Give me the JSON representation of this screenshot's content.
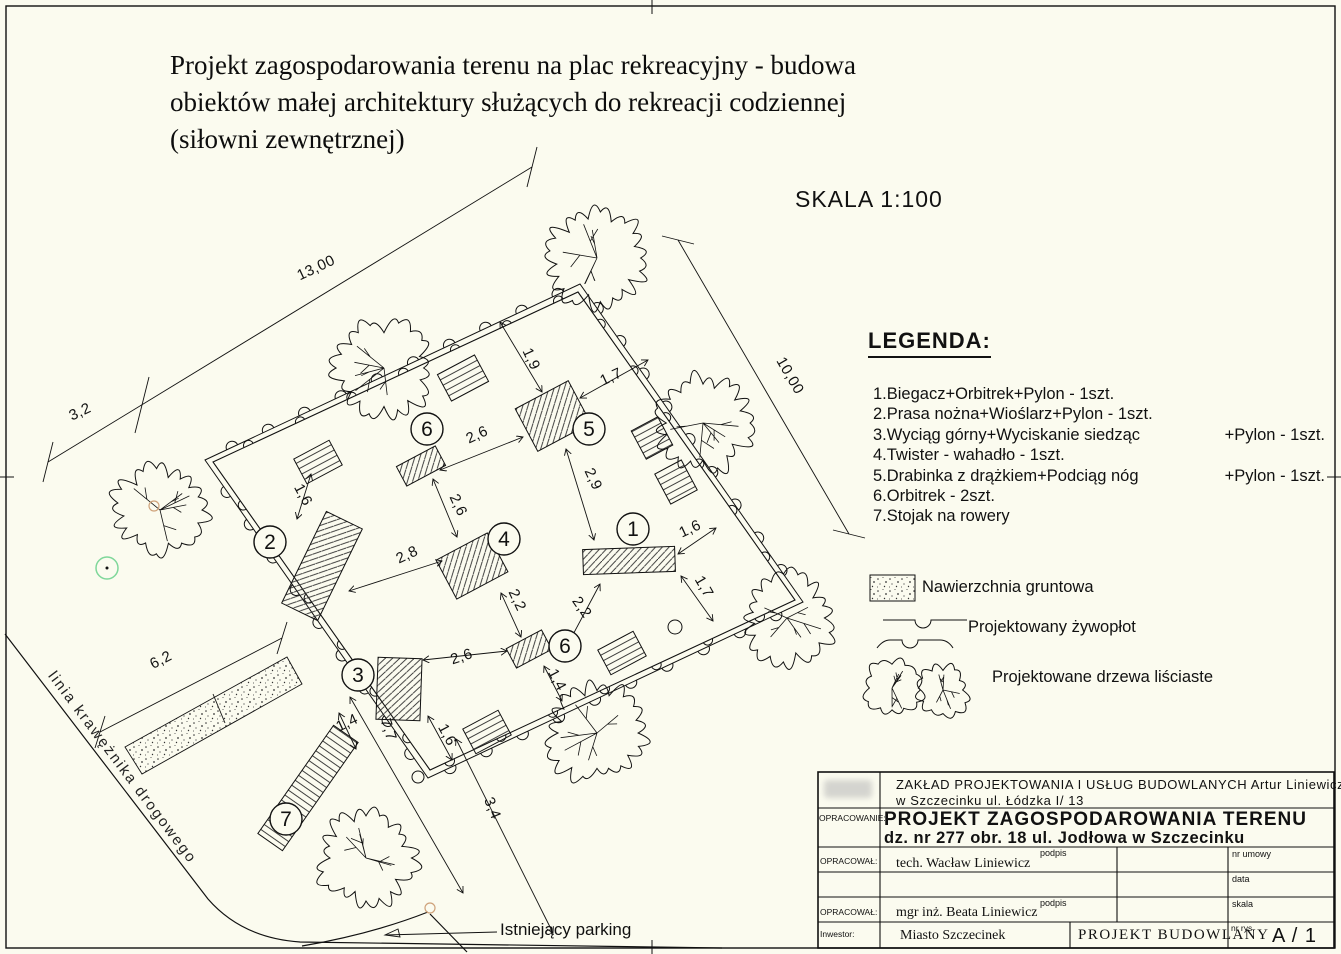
{
  "page": {
    "title_lines": [
      "Projekt zagospodarowania terenu na plac rekreacyjny - budowa",
      "obiektów małej architektury służących do rekreacji codziennej",
      "(siłowni zewnętrznej)"
    ],
    "scale_label": "SKALA 1:100"
  },
  "legend": {
    "heading": "LEGENDA:",
    "items": [
      {
        "text": "1.Biegacz+Orbitrek+Pylon - 1szt.",
        "extra": ""
      },
      {
        "text": "2.Prasa nożna+Wioślarz+Pylon - 1szt.",
        "extra": ""
      },
      {
        "text": "3.Wyciąg górny+Wyciskanie siedząc",
        "extra": "+Pylon - 1szt."
      },
      {
        "text": "4.Twister - wahadło - 1szt.",
        "extra": ""
      },
      {
        "text": "5.Drabinka z drążkiem+Podciąg nóg",
        "extra": "+Pylon - 1szt."
      },
      {
        "text": "6.Orbitrek - 2szt.",
        "extra": ""
      },
      {
        "text": "7.Stojak na rowery",
        "extra": ""
      }
    ],
    "symbols": [
      {
        "label": "Nawierzchnia gruntowa"
      },
      {
        "label": "Projektowany żywopłot"
      },
      {
        "label": "Projektowane drzewa liściaste"
      }
    ]
  },
  "plan": {
    "curb_label": "linia krawężnika drogowego",
    "parking_label": "Istniejący parking",
    "markers": [
      {
        "n": "1"
      },
      {
        "n": "2"
      },
      {
        "n": "3"
      },
      {
        "n": "4"
      },
      {
        "n": "5"
      },
      {
        "n": "6"
      },
      {
        "n": "6"
      },
      {
        "n": "7"
      }
    ],
    "dimensions": [
      {
        "v": "13,00"
      },
      {
        "v": "3,2"
      },
      {
        "v": "10,00"
      },
      {
        "v": "6,2"
      },
      {
        "v": "1,9"
      },
      {
        "v": "1,7"
      },
      {
        "v": "2,6"
      },
      {
        "v": "2,9"
      },
      {
        "v": "2,6"
      },
      {
        "v": "2,8"
      },
      {
        "v": "1,6"
      },
      {
        "v": "2,6"
      },
      {
        "v": "2,2"
      },
      {
        "v": "2,2"
      },
      {
        "v": "1,6"
      },
      {
        "v": "1,7"
      },
      {
        "v": "1,4"
      },
      {
        "v": "7,7"
      },
      {
        "v": "1,6"
      },
      {
        "v": "1,4"
      },
      {
        "v": "3,4"
      }
    ]
  },
  "title_block": {
    "company_line1": "ZAKŁAD PROJEKTOWANIA I USŁUG BUDOWLANYCH Artur Liniewicz",
    "company_line2": "w Szczecinku ul. Łódzka I/ 13",
    "opracowanie_label": "OPRACOWANIE:",
    "project_title_line1": "PROJEKT ZAGOSPODAROWANIA TERENU",
    "project_title_line2": "dz. nr 277 obr. 18 ul. Jodłowa w Szczecinku",
    "opracowal_label_1": "OPRACOWAŁ:",
    "opracowal_label_2": "OPRACOWAŁ:",
    "author1": "tech. Wacław Liniewicz",
    "author2": "mgr inż. Beata Liniewicz",
    "podpis_label_1": "podpis",
    "podpis_label_2": "podpis",
    "nr_umowy_label": "nr umowy",
    "data_label": "data",
    "skala_label": "skala",
    "inwestor_label": "Inwestor:",
    "inwestor_value": "Miasto Szczecinek",
    "project_type": "PROJEKT BUDOWLANY",
    "nr_rys_label": "nr rys.",
    "drawing_number": "A / 1"
  }
}
